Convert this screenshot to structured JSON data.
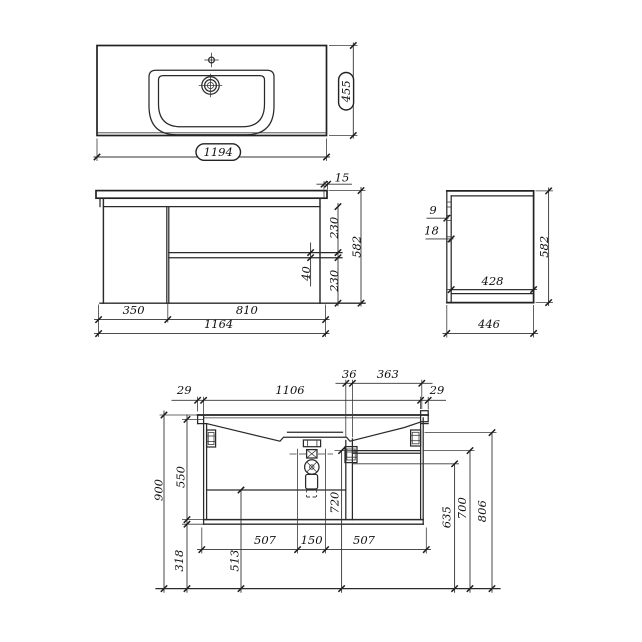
{
  "drawing": {
    "background": "#ffffff",
    "line_color": "#222222",
    "text_color": "#111111",
    "top_view": {
      "width": "1194",
      "depth": "455"
    },
    "front_view": {
      "top_overhang": "15",
      "upper_drawer_height": "230",
      "drawer_gap": "40",
      "lower_drawer_height": "230",
      "overall_height": "582",
      "left_width": "350",
      "right_width": "810",
      "overall_width": "1164"
    },
    "side_view": {
      "offset_9": "9",
      "offset_18": "18",
      "overall_height": "582",
      "inner_depth": "428",
      "overall_depth": "446"
    },
    "section_view": {
      "partition": "36",
      "top_right_span": "363",
      "left_overhang": "29",
      "inner_width": "1106",
      "right_overhang": "29",
      "overall_height": "900",
      "carcass_height": "550",
      "wall_clearance": "318",
      "front_height": "513",
      "left_drawer_width": "507",
      "drain_spacing": "150",
      "right_drawer_width": "507",
      "trap_height": "720",
      "level_635": "635",
      "level_700": "700",
      "level_806": "806"
    }
  }
}
